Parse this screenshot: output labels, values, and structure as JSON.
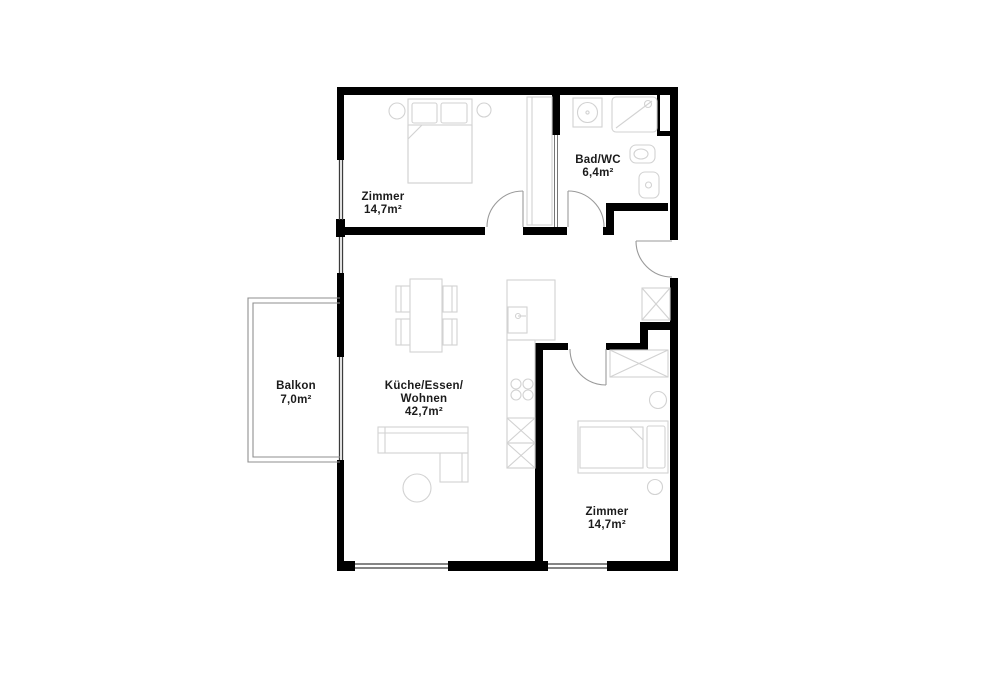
{
  "plan": {
    "type": "apartment-floor-plan",
    "rooms": {
      "zimmer_top": {
        "label": "Zimmer",
        "area": "14,7m²"
      },
      "bad": {
        "label": "Bad/WC",
        "area": "6,4m²"
      },
      "balkon": {
        "label": "Balkon",
        "area": "7,0m²"
      },
      "wohnen": {
        "label_line1": "Küche/Essen/",
        "label_line2": "Wohnen",
        "area": "42,7m²"
      },
      "zimmer_bottom": {
        "label": "Zimmer",
        "area": "14,7m²"
      }
    },
    "colors": {
      "wall": "#000000",
      "background": "#ffffff",
      "furniture_line": "#d2d2d2",
      "door_line": "#9a9a9a",
      "window_line": "#3c3c3c",
      "label_text": "#1b1b1b"
    }
  }
}
